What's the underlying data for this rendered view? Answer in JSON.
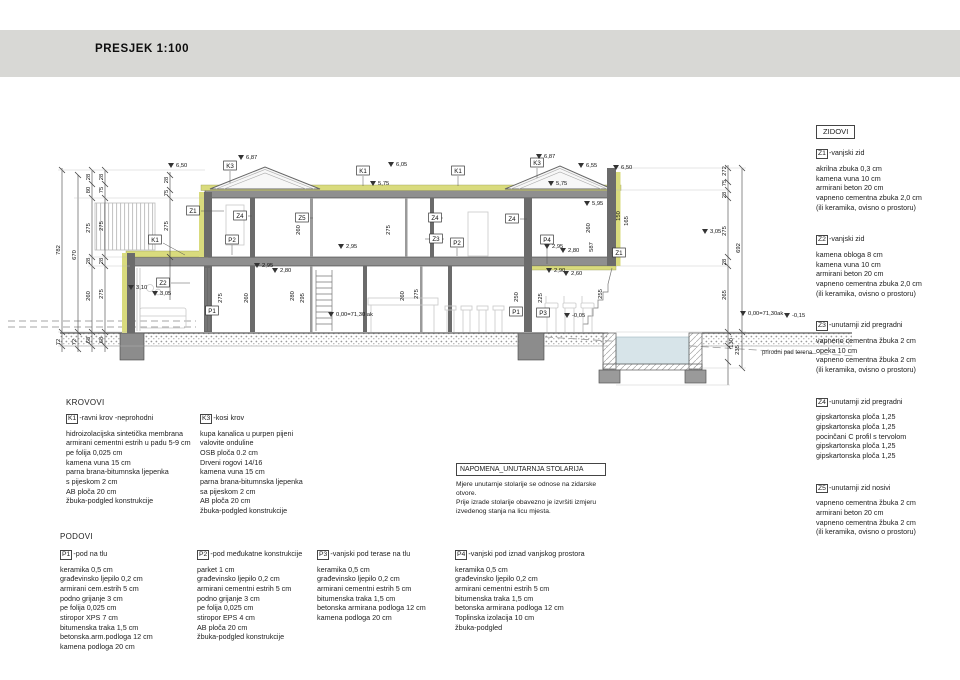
{
  "title": "PRESJEK  1:100",
  "zidovi": {
    "panel_title": "ZIDOVI",
    "items": [
      {
        "code": "Z1",
        "name": "-vanjski zid",
        "layers": [
          "akrilna zbuka 0,3 cm",
          "kamena vuna 10 cm",
          "armirani beton 20 cm",
          "vapneno cementna zbuka 2,0 cm",
          "(ili keramika, ovisno o prostoru)"
        ]
      },
      {
        "code": "Z2",
        "name": "-vanjski zid",
        "layers": [
          "kamena obloga 8 cm",
          "kamena vuna 10 cm",
          "armirani beton 20 cm",
          "vapneno cementna zbuka 2,0 cm",
          "(ili keramika, ovisno o prostoru)"
        ]
      },
      {
        "code": "Z3",
        "name": "-unutarnji zid pregradni",
        "layers": [
          "vapneno cementna žbuka 2 cm",
          "opeka 10 cm",
          "vapneno cementna žbuka 2 cm",
          "(ili keramika, ovisno o prostoru)"
        ]
      },
      {
        "code": "Z4",
        "name": "-unutarnji zid pregradni",
        "layers": [
          "gipskartonska ploča 1,25",
          "gipskartonska ploča 1,25",
          "pocinčani C profil s tervolom",
          "gipskartonska ploča 1,25",
          "gipskartonska ploča 1,25"
        ]
      },
      {
        "code": "Z5",
        "name": "-unutarnji zid nosivi",
        "layers": [
          "vapneno cementna žbuka 2 cm",
          "armirani beton 20 cm",
          "vapneno cementna žbuka 2 cm",
          "(ili keramika, ovisno o prostoru)"
        ]
      }
    ]
  },
  "krovovi": {
    "heading": "KROVOVI",
    "items": [
      {
        "code": "K1",
        "name": "-ravni krov -neprohodni",
        "layers": [
          "hidroizolacijska sintetička membrana",
          "armirani cementni estrih u padu 5-9 cm",
          "pe folija 0,025 cm",
          "kamena vuna 15 cm",
          "parna brana-bitumnska ljepenka",
          "s pijeskom 2 cm",
          "AB ploča 20 cm",
          "žbuka-podgled konstrukcije"
        ]
      },
      {
        "code": "K3",
        "name": "-kosi krov",
        "layers": [
          "kupa kanalica u purpen pijeni",
          "valovite onduline",
          "OSB ploča 0.2 cm",
          "Drveni rogovi 14/16",
          "kamena vuna 15 cm",
          "parna brana-bitumnska ljepenka",
          "sa pijeskom 2 cm",
          "AB ploča 20 cm",
          "žbuka-podgled konstrukcije"
        ]
      }
    ]
  },
  "podovi": {
    "heading": "PODOVI",
    "items": [
      {
        "code": "P1",
        "name": "-pod na tlu",
        "layers": [
          "keramika 0,5 cm",
          "građevinsko ljepilo 0,2 cm",
          "armirani cem.estrih 5 cm",
          "podno grijanje 3 cm",
          "pe folija 0,025 cm",
          "stiropor XPS 7 cm",
          "bitumenska traka 1,5 cm",
          "betonska.arm.podloga 12 cm",
          "kamena podloga 20 cm"
        ]
      },
      {
        "code": "P2",
        "name": "-pod međukatne konstrukcije",
        "layers": [
          "parket  1 cm",
          "građevinsko ljepilo 0,2 cm",
          "armirani cementni estrih 5 cm",
          "podno grijanje 3 cm",
          "pe folija 0,025 cm",
          "stiropor EPS 4 cm",
          "AB ploča 20 cm",
          "žbuka-podgled konstrukcije"
        ]
      },
      {
        "code": "P3",
        "name": "-vanjski pod terase na tlu",
        "layers": [
          "keramika 0,5 cm",
          "građevinsko ljepilo 0,2 cm",
          "armirani cementni estrih 5 cm",
          "bitumenska traka 1,5 cm",
          "betonska armirana podloga 12 cm",
          "kamena podloga 20 cm"
        ]
      },
      {
        "code": "P4",
        "name": "-vanjski pod iznad vanjskog prostora",
        "layers": [
          "keramika 0,5 cm",
          "građevinsko ljepilo 0,2 cm",
          "armirani cementni estrih 5 cm",
          "bitumenska traka 1,5 cm",
          "betonska armirana podloga 12 cm",
          "Toplinska izolacija 10 cm",
          "žbuka-podgled"
        ]
      }
    ]
  },
  "napomena": {
    "title": "NAPOMENA_UNUTARNJA STOLARIJA",
    "lines": [
      "Mjere unutarnje stolarije se odnose na zidarske",
      "otvore.",
      "Prije izrade stolarije obavezno je izvršiti izmjeru",
      "izvedenog stanja na licu mjesta."
    ]
  },
  "drawing": {
    "terrain_label": "prirodni pad terena",
    "colors": {
      "insulation": "#d9db7d",
      "wall": "#6b6b6b",
      "slab": "#8f8f8f",
      "water": "#d7e4e9",
      "line": "#333333"
    },
    "boxed_labels": [
      {
        "t": "K1",
        "x": 155,
        "y": 240
      },
      {
        "t": "K3",
        "x": 230,
        "y": 166
      },
      {
        "t": "K1",
        "x": 363,
        "y": 171
      },
      {
        "t": "K1",
        "x": 458,
        "y": 171
      },
      {
        "t": "K3",
        "x": 537,
        "y": 163
      },
      {
        "t": "Z1",
        "x": 193,
        "y": 211
      },
      {
        "t": "Z4",
        "x": 240,
        "y": 216
      },
      {
        "t": "Z5",
        "x": 302,
        "y": 218
      },
      {
        "t": "Z4",
        "x": 435,
        "y": 218
      },
      {
        "t": "Z3",
        "x": 436,
        "y": 239
      },
      {
        "t": "Z4",
        "x": 512,
        "y": 219
      },
      {
        "t": "P4",
        "x": 547,
        "y": 240
      },
      {
        "t": "Z1",
        "x": 619,
        "y": 253
      },
      {
        "t": "Z2",
        "x": 163,
        "y": 283
      },
      {
        "t": "P2",
        "x": 232,
        "y": 240
      },
      {
        "t": "P2",
        "x": 457,
        "y": 243
      },
      {
        "t": "P1",
        "x": 212,
        "y": 311
      },
      {
        "t": "P1",
        "x": 516,
        "y": 312
      },
      {
        "t": "P3",
        "x": 543,
        "y": 313
      }
    ],
    "elevations": [
      {
        "t": "6,50",
        "x": 176,
        "y": 167
      },
      {
        "t": "6,87",
        "x": 246,
        "y": 159
      },
      {
        "t": "6,05",
        "x": 396,
        "y": 166
      },
      {
        "t": "5,75",
        "x": 378,
        "y": 185
      },
      {
        "t": "6,87",
        "x": 544,
        "y": 158
      },
      {
        "t": "5,75",
        "x": 556,
        "y": 185
      },
      {
        "t": "6,55",
        "x": 586,
        "y": 167
      },
      {
        "t": "6,50",
        "x": 621,
        "y": 169
      },
      {
        "t": "5,95",
        "x": 592,
        "y": 205
      },
      {
        "t": "3,10",
        "x": 136,
        "y": 289
      },
      {
        "t": "3,05",
        "x": 160,
        "y": 295
      },
      {
        "t": "3,05",
        "x": 710,
        "y": 233
      },
      {
        "t": "2,95",
        "x": 262,
        "y": 267
      },
      {
        "t": "2,80",
        "x": 280,
        "y": 272
      },
      {
        "t": "2,95",
        "x": 346,
        "y": 248
      },
      {
        "t": "2,95",
        "x": 552,
        "y": 248
      },
      {
        "t": "2,80",
        "x": 568,
        "y": 252
      },
      {
        "t": "2,90",
        "x": 554,
        "y": 272
      },
      {
        "t": "2,60",
        "x": 571,
        "y": 275
      },
      {
        "t": "0,00=71,30 ak",
        "x": 336,
        "y": 316
      },
      {
        "t": "0,00=71,30ak",
        "x": 748,
        "y": 315
      },
      {
        "t": "-0,05",
        "x": 572,
        "y": 317
      },
      {
        "t": "-0,15",
        "x": 792,
        "y": 317
      }
    ],
    "dims": [
      {
        "t": "782",
        "x": 60,
        "y": 250
      },
      {
        "t": "670",
        "x": 76,
        "y": 255
      },
      {
        "t": "28",
        "x": 90,
        "y": 177
      },
      {
        "t": "80",
        "x": 90,
        "y": 190
      },
      {
        "t": "275",
        "x": 90,
        "y": 228
      },
      {
        "t": "28",
        "x": 90,
        "y": 261
      },
      {
        "t": "260",
        "x": 90,
        "y": 296
      },
      {
        "t": "68",
        "x": 90,
        "y": 340
      },
      {
        "t": "72",
        "x": 60,
        "y": 342
      },
      {
        "t": "72",
        "x": 76,
        "y": 342
      },
      {
        "t": "28",
        "x": 103,
        "y": 177
      },
      {
        "t": "75",
        "x": 103,
        "y": 190
      },
      {
        "t": "275",
        "x": 103,
        "y": 226
      },
      {
        "t": "28",
        "x": 103,
        "y": 261
      },
      {
        "t": "275",
        "x": 103,
        "y": 294
      },
      {
        "t": "68",
        "x": 103,
        "y": 340
      },
      {
        "t": "28",
        "x": 168,
        "y": 180
      },
      {
        "t": "75",
        "x": 168,
        "y": 193
      },
      {
        "t": "275",
        "x": 168,
        "y": 226
      },
      {
        "t": "275",
        "x": 222,
        "y": 298
      },
      {
        "t": "260",
        "x": 248,
        "y": 298
      },
      {
        "t": "280",
        "x": 294,
        "y": 296
      },
      {
        "t": "295",
        "x": 304,
        "y": 298
      },
      {
        "t": "260",
        "x": 404,
        "y": 296
      },
      {
        "t": "275",
        "x": 418,
        "y": 294
      },
      {
        "t": "250",
        "x": 518,
        "y": 297
      },
      {
        "t": "225",
        "x": 542,
        "y": 298
      },
      {
        "t": "255",
        "x": 602,
        "y": 294
      },
      {
        "t": "260",
        "x": 300,
        "y": 230
      },
      {
        "t": "275",
        "x": 390,
        "y": 230
      },
      {
        "t": "260",
        "x": 590,
        "y": 228
      },
      {
        "t": "587",
        "x": 593,
        "y": 247
      },
      {
        "t": "150",
        "x": 620,
        "y": 216
      },
      {
        "t": "165",
        "x": 628,
        "y": 221
      },
      {
        "t": "272",
        "x": 726,
        "y": 171
      },
      {
        "t": "75",
        "x": 726,
        "y": 183
      },
      {
        "t": "28",
        "x": 726,
        "y": 195
      },
      {
        "t": "275",
        "x": 726,
        "y": 231
      },
      {
        "t": "28",
        "x": 726,
        "y": 262
      },
      {
        "t": "265",
        "x": 726,
        "y": 295
      },
      {
        "t": "130",
        "x": 733,
        "y": 343
      },
      {
        "t": "692",
        "x": 740,
        "y": 248
      },
      {
        "t": "235",
        "x": 739,
        "y": 350
      }
    ]
  }
}
